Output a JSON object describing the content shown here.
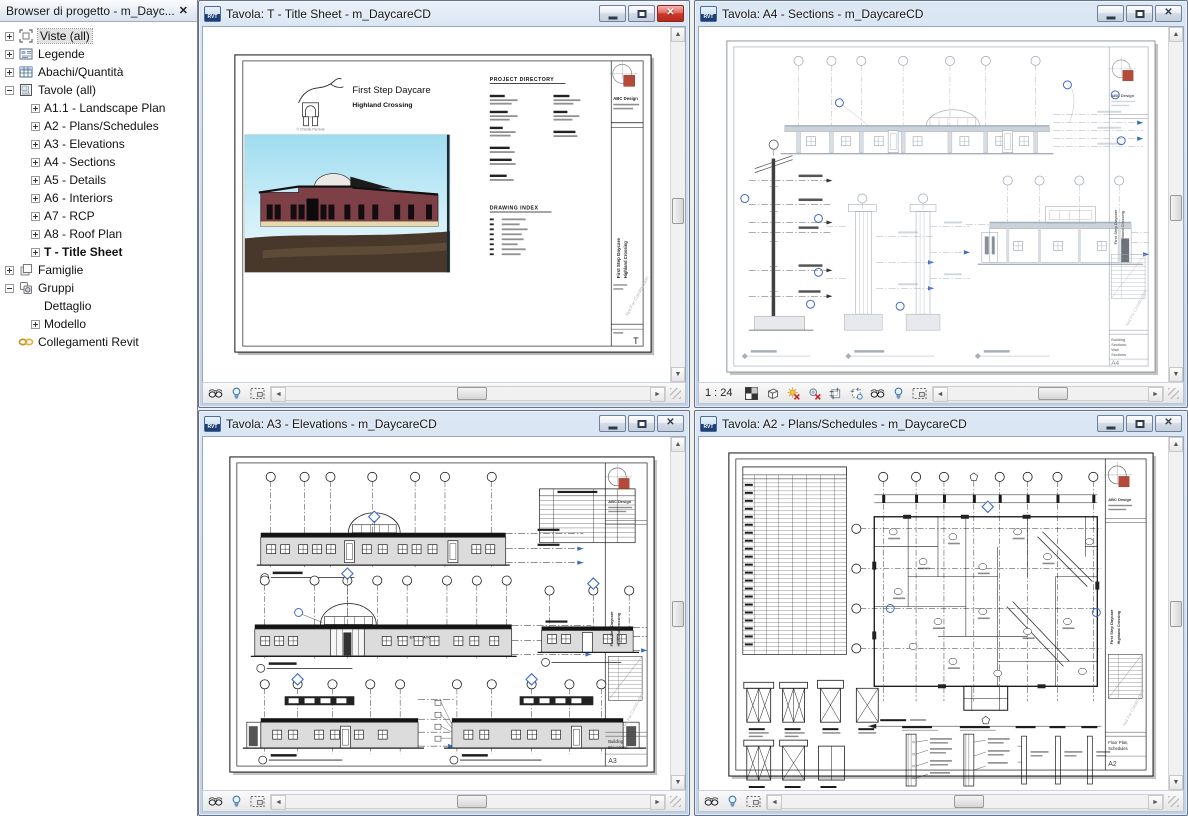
{
  "browser": {
    "title": "Browser di progetto - m_Dayc...",
    "close_glyph": "✕",
    "tree": [
      {
        "label": "Viste (all)",
        "level": 0,
        "expander": "plus",
        "icon": "viste",
        "selected": true
      },
      {
        "label": "Legende",
        "level": 0,
        "expander": "plus",
        "icon": "legende"
      },
      {
        "label": "Abachi/Quantità",
        "level": 0,
        "expander": "plus",
        "icon": "abachi"
      },
      {
        "label": "Tavole (all)",
        "level": 0,
        "expander": "minus",
        "icon": "tavole"
      },
      {
        "label": "A1.1 - Landscape Plan",
        "level": 1,
        "expander": "plus"
      },
      {
        "label": "A2 - Plans/Schedules",
        "level": 1,
        "expander": "plus"
      },
      {
        "label": "A3 - Elevations",
        "level": 1,
        "expander": "plus"
      },
      {
        "label": "A4 - Sections",
        "level": 1,
        "expander": "plus"
      },
      {
        "label": "A5 - Details",
        "level": 1,
        "expander": "plus"
      },
      {
        "label": "A6 - Interiors",
        "level": 1,
        "expander": "plus"
      },
      {
        "label": "A7 - RCP",
        "level": 1,
        "expander": "plus"
      },
      {
        "label": "A8 - Roof Plan",
        "level": 1,
        "expander": "plus"
      },
      {
        "label": "T - Title Sheet",
        "level": 1,
        "expander": "plus",
        "bold": true
      },
      {
        "label": "Famiglie",
        "level": 0,
        "expander": "plus",
        "icon": "famiglie"
      },
      {
        "label": "Gruppi",
        "level": 0,
        "expander": "minus",
        "icon": "gruppi"
      },
      {
        "label": "Dettaglio",
        "level": 1,
        "expander": "none"
      },
      {
        "label": "Modello",
        "level": 1,
        "expander": "plus"
      },
      {
        "label": "Collegamenti Revit",
        "level": 0,
        "expander": "none",
        "icon": "link"
      }
    ]
  },
  "windows": {
    "t": {
      "title": "Tavola: T - Title Sheet - m_DaycareCD"
    },
    "a4": {
      "title": "Tavola: A4 - Sections - m_DaycareCD",
      "scale": "1 : 24"
    },
    "a3": {
      "title": "Tavola: A3 - Elevations - m_DaycareCD"
    },
    "a2": {
      "title": "Tavola: A2 - Plans/Schedules - m_DaycareCD"
    }
  },
  "sheets": {
    "common": {
      "firm": "ABC Design",
      "project": "First Step Daycare",
      "location": "Highland Crossing",
      "watermark": "Not For Construction"
    },
    "t": {
      "project_title": "First Step Daycare",
      "subtitle": "Highland Crossing",
      "credit": "© Christie Percival",
      "directory_heading": "PROJECT DIRECTORY",
      "index_heading": "DRAWING INDEX",
      "sheet_no": "T"
    },
    "a4": {
      "sheet_no": "A4",
      "title_lines": [
        "Building",
        "Sections,",
        "Wall",
        "Sections"
      ]
    },
    "a3": {
      "sheet_no": "A3",
      "sign": "FIRST STEP DAYCARE",
      "title_lines": [
        "Building",
        "Elevations"
      ]
    },
    "a2": {
      "sheet_no": "A2",
      "title_lines": [
        "Floor Plan,",
        "Schedules"
      ]
    }
  },
  "icons": {
    "panel-close": "x-glyph",
    "revit-file": "rvt-document",
    "minimize": "dash",
    "restore": "square",
    "close": "x-glyph",
    "temporary-hide-isolate": "glasses",
    "reveal-hidden-elements": "lightbulb",
    "selection-toggle": "selection-box",
    "detail-level": "checker-square",
    "visual-style": "cube",
    "sun-path-off": "sun-red-x",
    "shadows-off": "circle-red-x",
    "crop-view": "crop-frame",
    "crop-region-visibility": "crop-frame-bulb",
    "scroll-up": "▲",
    "scroll-down": "▼",
    "scroll-left": "◄",
    "scroll-right": "►"
  },
  "colors": {
    "annotation_blue": "#3f6bc6",
    "titleblock_red": "#b5493a",
    "active_close_red": "#cf3a2c",
    "halftone_gray": "#a6afbb",
    "wall_fill": "#dcdcdc",
    "sky_top": "#9fdcf0",
    "brick": "#7c4046",
    "ground_brown": "#47382b"
  }
}
